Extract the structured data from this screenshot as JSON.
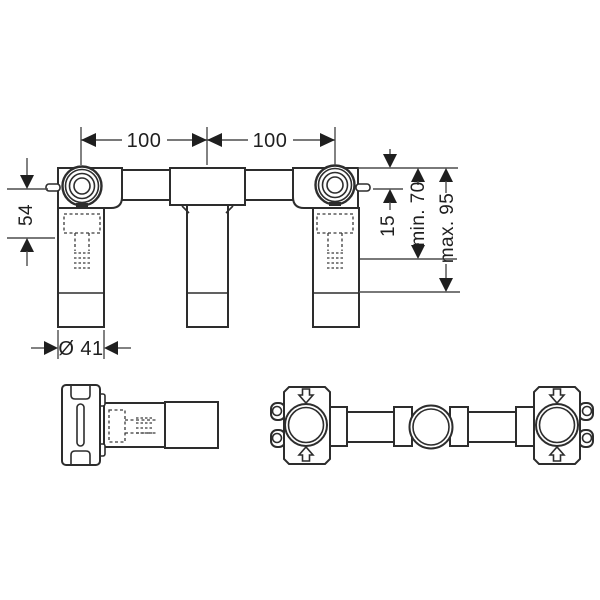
{
  "drawing": {
    "dim_width_left": "100",
    "dim_width_right": "100",
    "dim_height_54": "54",
    "dim_offset_15": "15",
    "dim_depth_min": "min. 70",
    "dim_depth_max": "max. 95",
    "dim_diameter": "Ø 41"
  }
}
